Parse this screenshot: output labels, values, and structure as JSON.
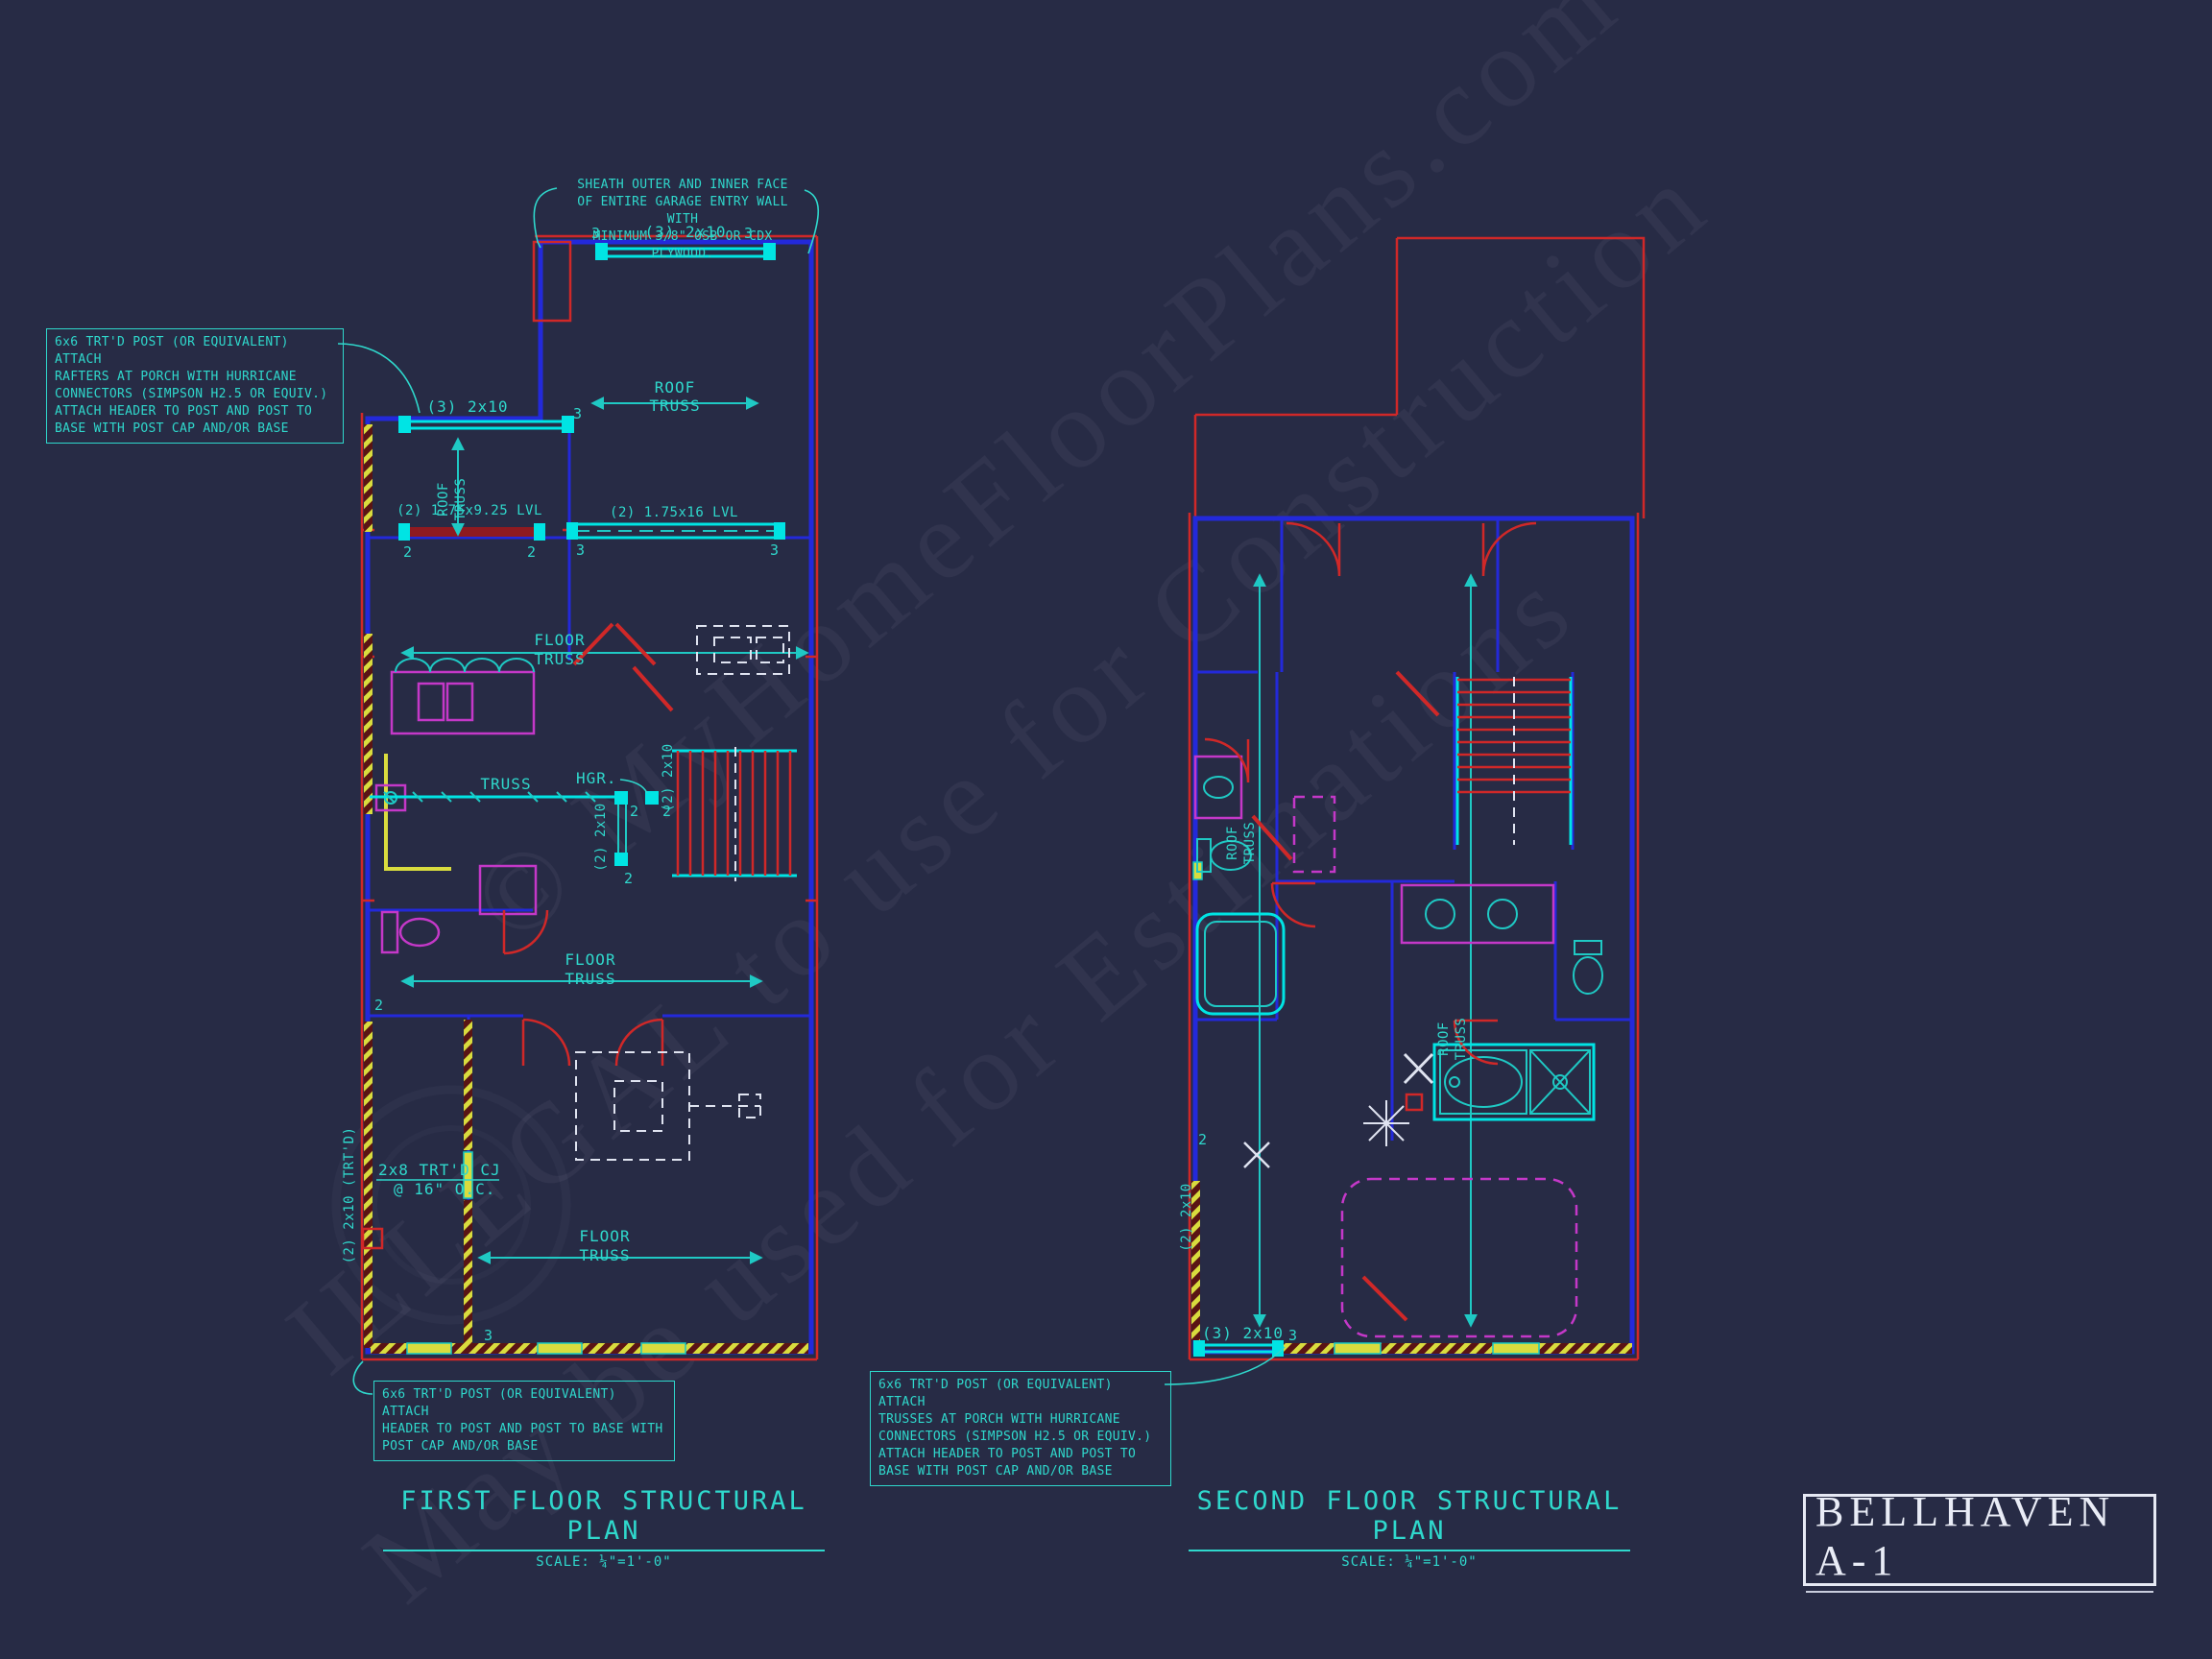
{
  "colors": {
    "background": "#272b45",
    "cad_blue": "#2329da",
    "cad_red": "#d02828",
    "cad_cyan_bright": "#00e4e4",
    "cad_cyan_text": "#2fd8cc",
    "cad_magenta": "#c438c8",
    "cad_yellow": "#d9dc3e",
    "cad_white": "#e6e9f4"
  },
  "watermark": {
    "line1": "© MyHomeFloorPlans.com",
    "line2": "ILLEGAL to use for Construction",
    "line3": "May be used for Estimations"
  },
  "annotations": {
    "sheath": {
      "l1": "SHEATH OUTER AND INNER FACE",
      "l2": "OF ENTIRE GARAGE ENTRY WALL WITH",
      "l3": "MINIMUM 3/8\" OSB OR CDX PLYWOOD."
    },
    "post_rafters": {
      "l1": "6x6 TRT'D POST (OR EQUIVALENT) ATTACH",
      "l2": "RAFTERS AT PORCH WITH HURRICANE",
      "l3": "CONNECTORS (SIMPSON H2.5 OR EQUIV.)",
      "l4": "ATTACH HEADER TO POST AND POST TO",
      "l5": "BASE WITH POST CAP AND/OR BASE"
    },
    "post_header": {
      "l1": "6x6 TRT'D POST (OR EQUIVALENT) ATTACH",
      "l2": "HEADER TO POST AND POST TO BASE WITH",
      "l3": "POST CAP AND/OR BASE"
    },
    "post_trusses": {
      "l1": "6x6 TRT'D POST (OR EQUIVALENT) ATTACH",
      "l2": "TRUSSES AT PORCH WITH HURRICANE",
      "l3": "CONNECTORS (SIMPSON H2.5 OR EQUIV.)",
      "l4": "ATTACH HEADER TO POST AND POST TO",
      "l5": "BASE WITH POST CAP AND/OR BASE"
    }
  },
  "labels": {
    "roof": "ROOF",
    "floor": "FLOOR",
    "truss": "TRUSS",
    "h3_2x10": "(3) 2x10",
    "lvl925": "(2) 1.75x9.25 LVL",
    "lvl16": "(2) 1.75x16 LVL",
    "hgr": "HGR.",
    "v2x10": "(2) 2x10",
    "cj1": "2x8 TRT'D CJ",
    "cj2": "@ 16\" O.C.",
    "trtd2x10": "(2) 2x10 (TRT'D)",
    "m2": "2",
    "m3": "3"
  },
  "first_floor": {
    "title": "FIRST FLOOR STRUCTURAL PLAN",
    "scale": "SCALE: ¼\"=1'-0\""
  },
  "second_floor": {
    "title": "SECOND FLOOR STRUCTURAL PLAN",
    "scale": "SCALE: ¼\"=1'-0\""
  },
  "title_block": {
    "name": "BELLHAVEN A-1"
  }
}
